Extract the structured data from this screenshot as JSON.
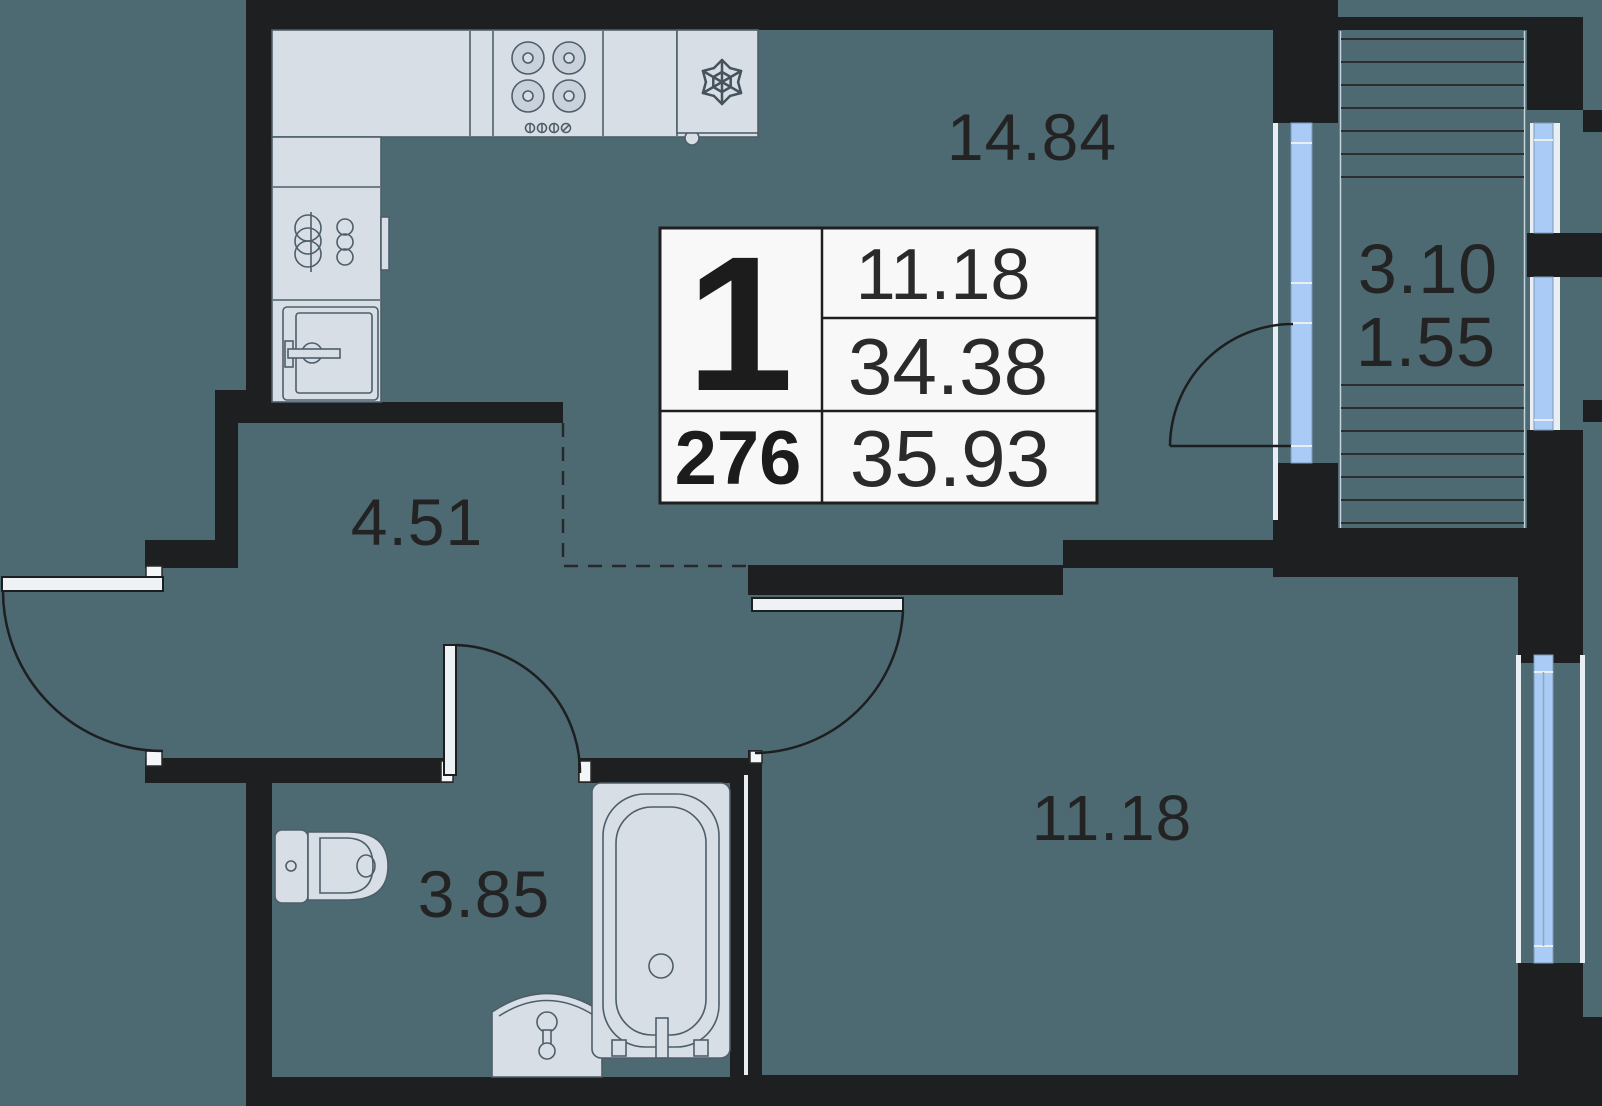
{
  "info_table": {
    "rooms_count": "1",
    "unit_number": "276",
    "living_area": "11.18",
    "area_without_balcony": "34.38",
    "total_area": "35.93"
  },
  "room_labels": {
    "kitchen_living": "14.84",
    "hallway": "4.51",
    "bathroom": "3.85",
    "bedroom": "11.18",
    "balcony_area": "3.10",
    "balcony_reduced_area": "1.55"
  },
  "colors": {
    "bg": "#4d6972",
    "wall": "#1e1f20",
    "fixture": "#d8dee6",
    "fixture-stroke": "#4e5e69",
    "glass": "#a9cbf6",
    "casing": "#e9eef3",
    "paper": "#f8f8f8",
    "ink": "#232323",
    "plan-line": "#26282a"
  }
}
